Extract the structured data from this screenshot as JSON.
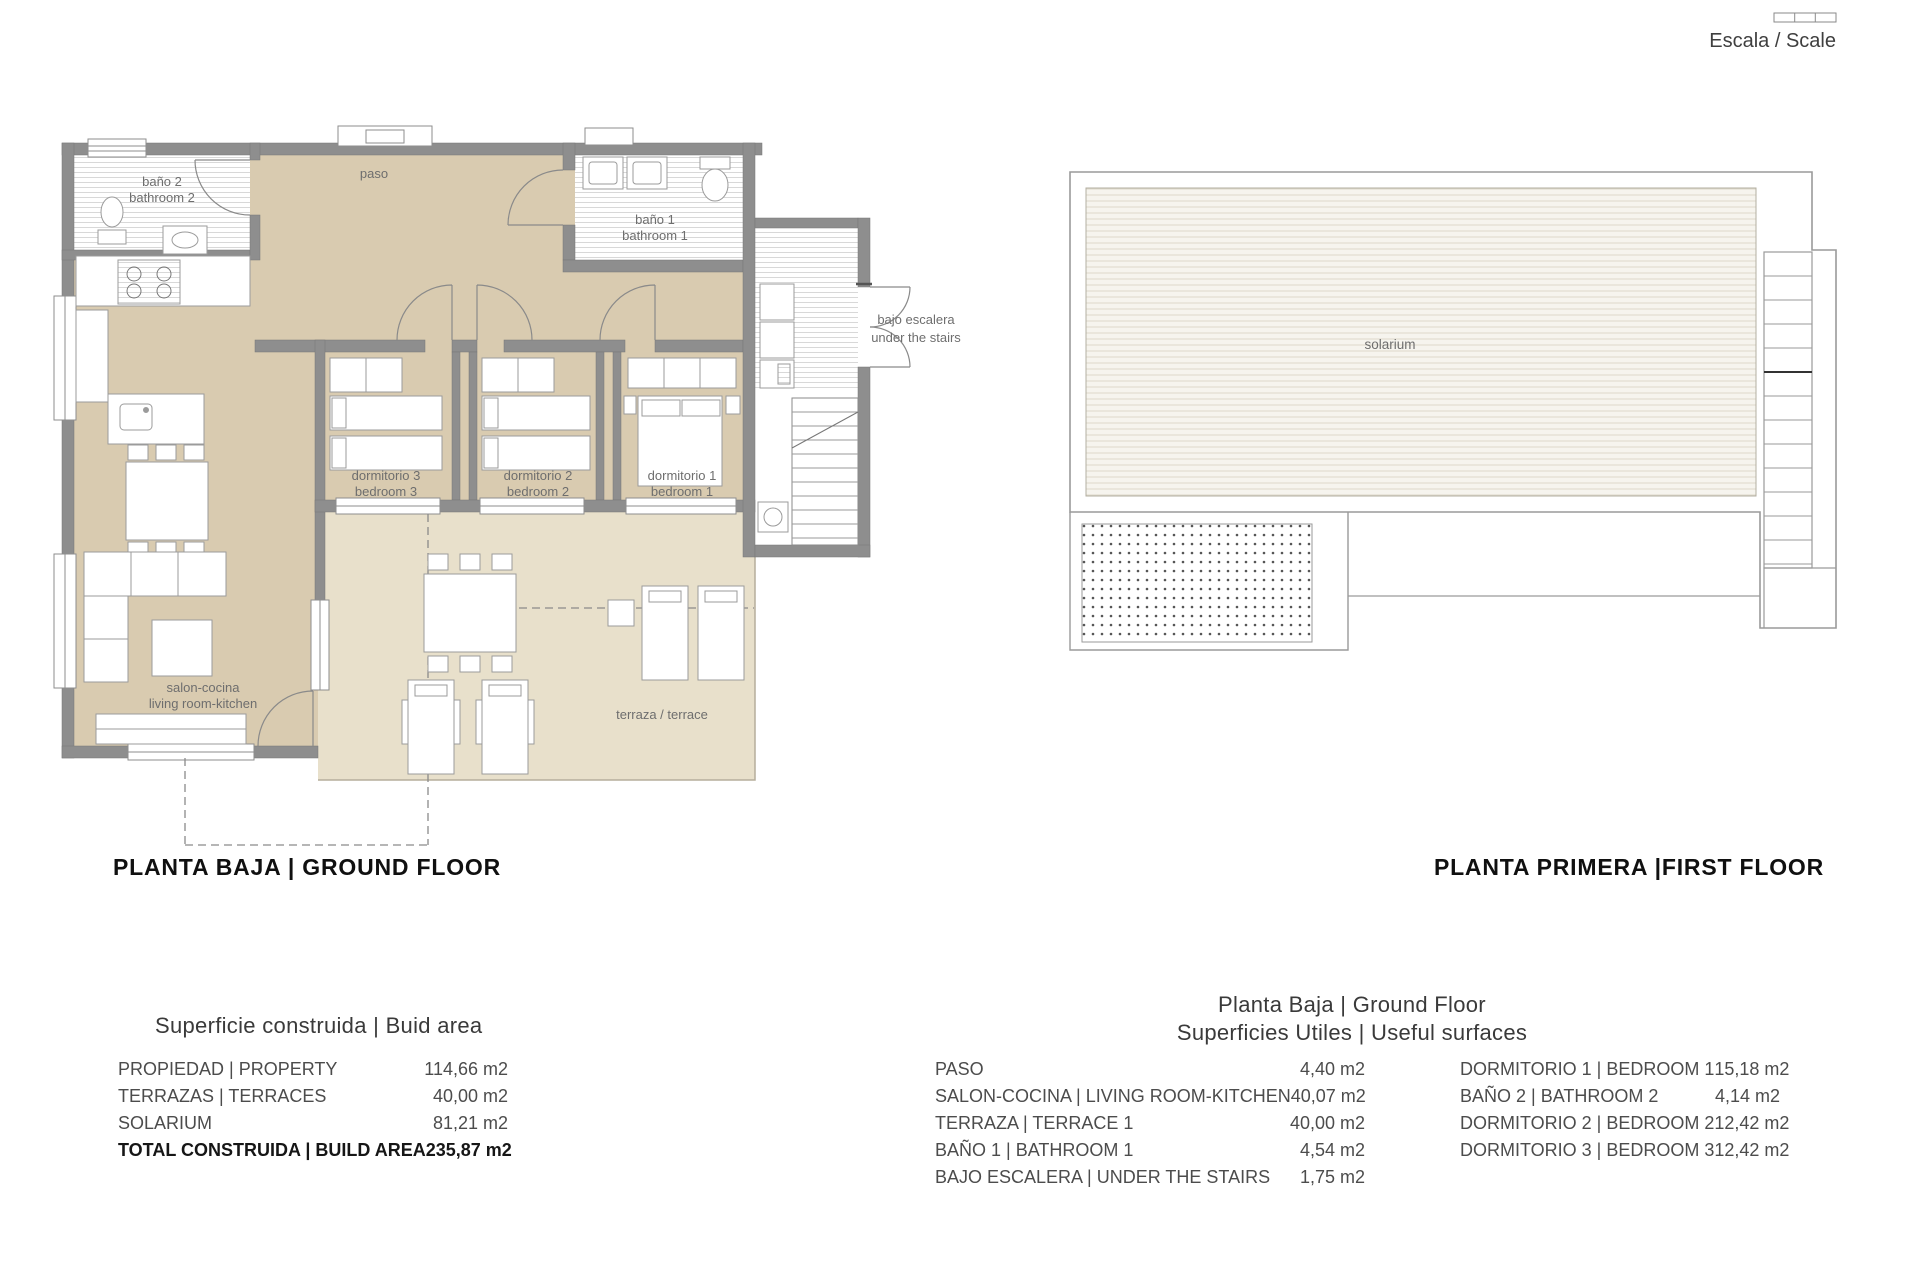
{
  "scale_indicator": {
    "label": "Escala / Scale"
  },
  "ground_floor_plan": {
    "title": "PLANTA BAJA | GROUND FLOOR",
    "labels": {
      "bath2_es": "baño 2",
      "bath2_en": "bathroom 2",
      "paso": "paso",
      "bath1_es": "baño 1",
      "bath1_en": "bathroom 1",
      "bed3_es": "dormitorio 3",
      "bed3_en": "bedroom 3",
      "bed2_es": "dormitorio 2",
      "bed2_en": "bedroom 2",
      "bed1_es": "dormitorio 1",
      "bed1_en": "bedroom 1",
      "salon_es": "salon-cocina",
      "salon_en": "living room-kitchen",
      "terrace": "terraza / terrace",
      "under_stairs_es": "bajo escalera",
      "under_stairs_en": "under the stairs"
    }
  },
  "first_floor_plan": {
    "title": "PLANTA PRIMERA |FIRST FLOOR",
    "labels": {
      "solarium": "solarium"
    }
  },
  "build_area_table": {
    "title": "Superficie construida | Buid area",
    "rows": [
      {
        "label": "PROPIEDAD | PROPERTY",
        "value": "114,66 m2"
      },
      {
        "label": "TERRAZAS | TERRACES",
        "value": "40,00 m2"
      },
      {
        "label": "SOLARIUM",
        "value": "81,21 m2"
      },
      {
        "label": "TOTAL CONSTRUIDA | BUILD AREA",
        "value": "235,87 m2"
      }
    ]
  },
  "useful_surfaces_table": {
    "title_line1": "Planta Baja | Ground Floor",
    "title_line2": "Superficies Utiles | Useful surfaces",
    "left_rows": [
      {
        "label": "PASO",
        "value": "4,40 m2"
      },
      {
        "label": "SALON-COCINA | LIVING ROOM-KITCHEN",
        "value": "40,07 m2"
      },
      {
        "label": "TERRAZA | TERRACE 1",
        "value": "40,00 m2"
      },
      {
        "label": "BAÑO 1 | BATHROOM 1",
        "value": "4,54 m2"
      },
      {
        "label": "BAJO ESCALERA | UNDER THE STAIRS",
        "value": "1,75 m2"
      }
    ],
    "right_rows": [
      {
        "label": "DORMITORIO 1 | BEDROOM 1",
        "value": "15,18 m2"
      },
      {
        "label": "BAÑO 2 | BATHROOM 2",
        "value": "4,14 m2"
      },
      {
        "label": "DORMITORIO 2 | BEDROOM 2",
        "value": "12,42 m2"
      },
      {
        "label": "DORMITORIO 3 | BEDROOM 3",
        "value": "12,42 m2"
      }
    ]
  },
  "colors": {
    "wall": "#8e8e8e",
    "interior": "#d9cbb0",
    "terrace": "#e8e0cb",
    "deck_line": "#ddd8cb",
    "outline": "#9a9a9a"
  }
}
